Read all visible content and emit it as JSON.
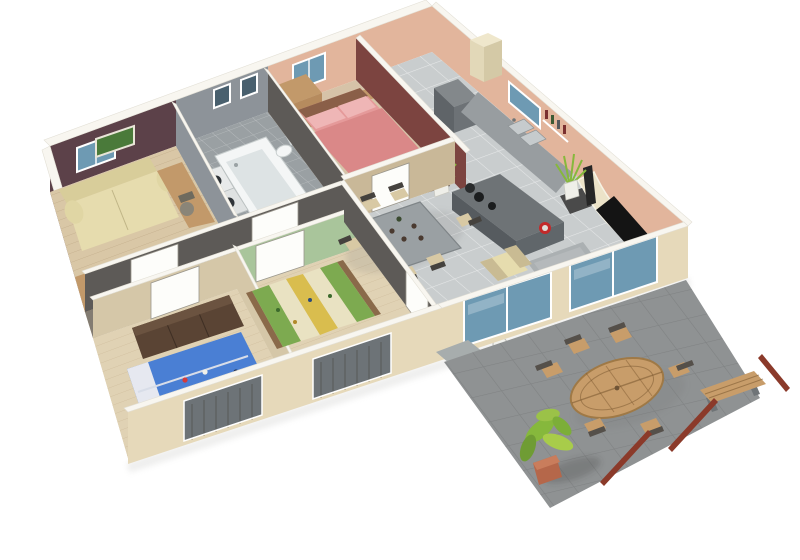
{
  "scene": {
    "type": "isometric-3d-floor-plan",
    "description": "3D cutaway floor plan of a single-storey house with open kitchen-living area, three bedrooms, bathroom, hallway and an outdoor stone terrace",
    "background": "#ffffff"
  },
  "palette": {
    "wall_top": "#f8f6f0",
    "wall_exterior": "#e6d9ba",
    "wall_salmon": "#e2b59c",
    "wall_maroon": "#5c4149",
    "wall_accent_red": "#7c4440",
    "wall_bath_gray": "#8d9399",
    "wall_interior_dark": "#5d5a57",
    "wall_green": "#a9c59b",
    "floor_wood_light": "#d9c7a6",
    "floor_wood_kids": "#e0d2b4",
    "floor_tile_gray": "#c9cdce",
    "floor_tile_bath": "#9aa0a3",
    "floor_beige": "#d6c3a8",
    "floor_hall": "#837c72",
    "terrace_tile": "#8f9293",
    "rug": "#abb0b2",
    "sofa_cream": "#e6dcae",
    "sofa_seat": "#d9cba8",
    "sofa_brown": "#6f5b49",
    "bed_pink": "#e59a9a",
    "bed_blue": "#4a7fd4",
    "bed_green": "#7daa50",
    "bed_yellow": "#d9bd4e",
    "bed_cream": "#e9e2c2",
    "wood_furniture": "#c2996a",
    "wood_dark": "#5a4434",
    "kitchen_cabinet": "#989da0",
    "kitchen_island": "#6e7376",
    "dining_table": "#9aa0a3",
    "glass_blue": "#6e9ab3",
    "glass_dark": "#49606e",
    "shutter_gray": "#6d7377",
    "tv_black": "#141414",
    "plant_green": "#86b83c",
    "pot_terracotta": "#b5674a",
    "table_wood": "#c89d6a",
    "pole_red": "#8b3a2a"
  },
  "rooms": [
    {
      "id": "office",
      "name": "Office / guest room",
      "floor": "light wood",
      "items": [
        "sofa bed",
        "desk",
        "office chair",
        "framed picture",
        "low wardrobe"
      ]
    },
    {
      "id": "bathroom",
      "name": "Bathroom",
      "floor": "grey tile",
      "items": [
        "bathtub",
        "toilet",
        "washing machines",
        "dark vanity"
      ]
    },
    {
      "id": "master-bedroom",
      "name": "Master bedroom",
      "floor": "beige",
      "items": [
        "double bed with pink bedding",
        "two pillows",
        "nightstand",
        "wardrobe",
        "storage cube rack"
      ]
    },
    {
      "id": "kitchen",
      "name": "Kitchen",
      "floor": "grey tile",
      "items": [
        "fridge",
        "tall cabinet",
        "sink counter",
        "cooktop island",
        "potted plants",
        "wall shelf with bottles"
      ]
    },
    {
      "id": "hallway",
      "name": "Hallway",
      "floor": "dark tile",
      "items": [
        "white interior doors"
      ]
    },
    {
      "id": "kids-room-blue",
      "name": "Kids bedroom (blue)",
      "floor": "light wood",
      "items": [
        "single bed with cartoon bedding",
        "dark wardrobe",
        "shuttered window"
      ]
    },
    {
      "id": "kids-room-green",
      "name": "Kids bedroom (green)",
      "floor": "light wood",
      "items": [
        "single bed with striped bedding",
        "shuttered window"
      ]
    },
    {
      "id": "living-dining",
      "name": "Living / dining room",
      "floor": "grey tile",
      "items": [
        "dining table",
        "six chairs",
        "armchair",
        "grey rug",
        "sofa",
        "side table",
        "curved TV unit",
        "flat screen TV",
        "speaker",
        "media unit",
        "plant",
        "sliding glass doors"
      ]
    },
    {
      "id": "terrace",
      "name": "Terrace",
      "floor": "stone tile",
      "items": [
        "oval garden table",
        "garden chairs",
        "wooden bench",
        "potted plant",
        "parasol poles"
      ]
    }
  ],
  "counts": {
    "dining_chairs": 6,
    "garden_chairs": 6,
    "hallway_doors": 4,
    "back_windows": 4
  }
}
